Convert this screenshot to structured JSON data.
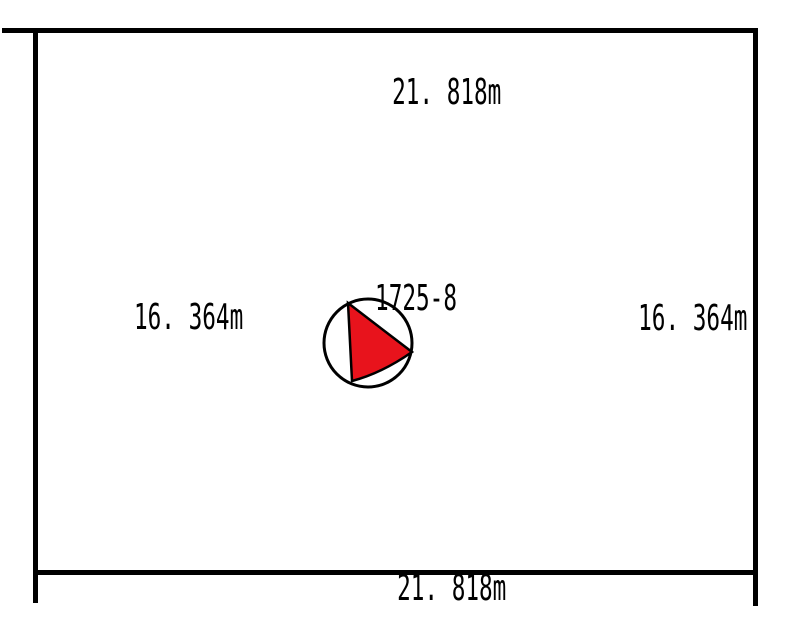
{
  "page": {
    "background": "#ffffff",
    "line_color": "#000000",
    "text_color": "#000000"
  },
  "plot": {
    "parcel_number": "1725-8",
    "dimensions": {
      "top": "21. 818m",
      "bottom": "21. 818m",
      "left": "16. 364m",
      "right": "16. 364m"
    },
    "marker": {
      "shape": "arrow-in-circle",
      "fill": "#e8131c",
      "stroke": "#000000"
    }
  }
}
